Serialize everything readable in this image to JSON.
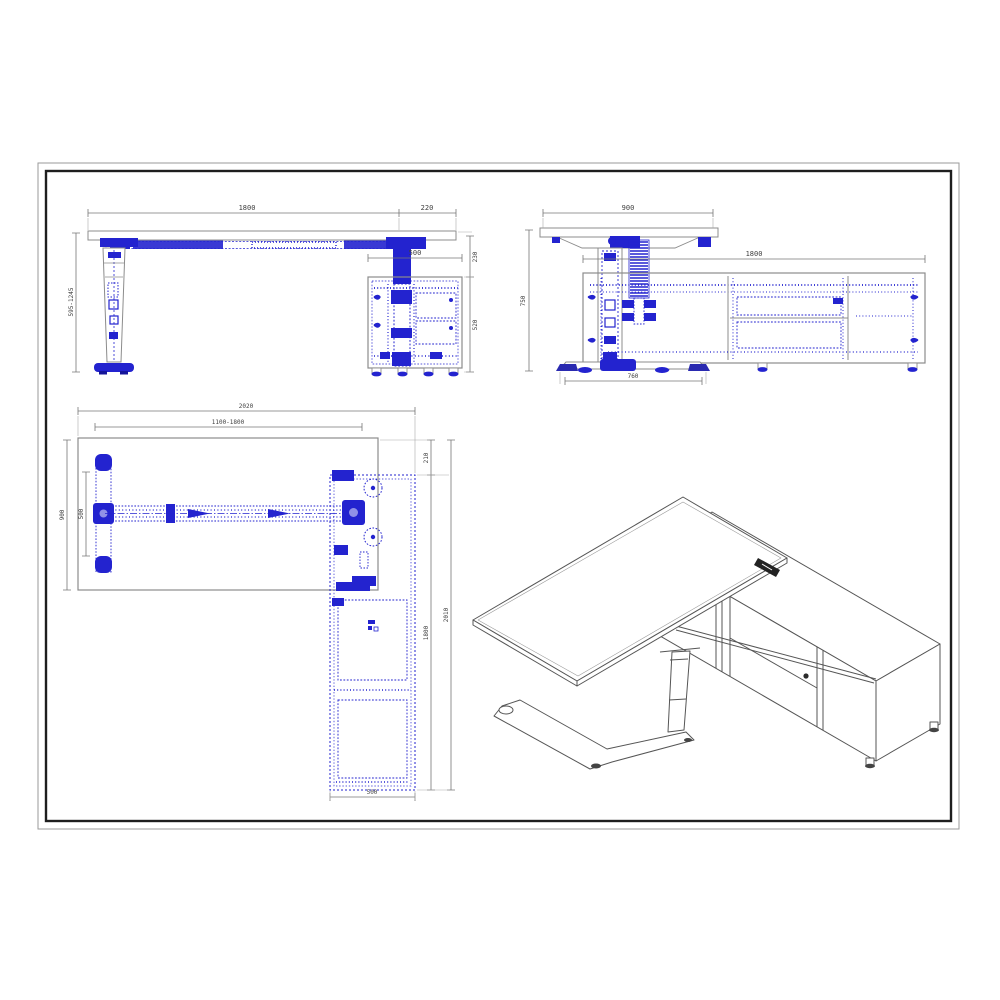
{
  "front": {
    "width": "1800",
    "overhang": "220",
    "cab_width": "500",
    "gap": "230",
    "cab_height": "520",
    "height_range": "595-1245"
  },
  "side": {
    "depth": "900",
    "cab_length": "1800",
    "height": "750",
    "foot": "760"
  },
  "plan": {
    "overall": "2020",
    "slide": "1100-1800",
    "depth": "900",
    "foot_len": "500",
    "offset": "210",
    "cab_length": "1800",
    "overall_depth": "2010",
    "cab_depth": "500"
  },
  "colors": {
    "hardware_blue": "#2323cf",
    "outline_gray": "#8c8c8c",
    "dim_gray": "#777777",
    "frame_black": "#1e1e1e"
  }
}
